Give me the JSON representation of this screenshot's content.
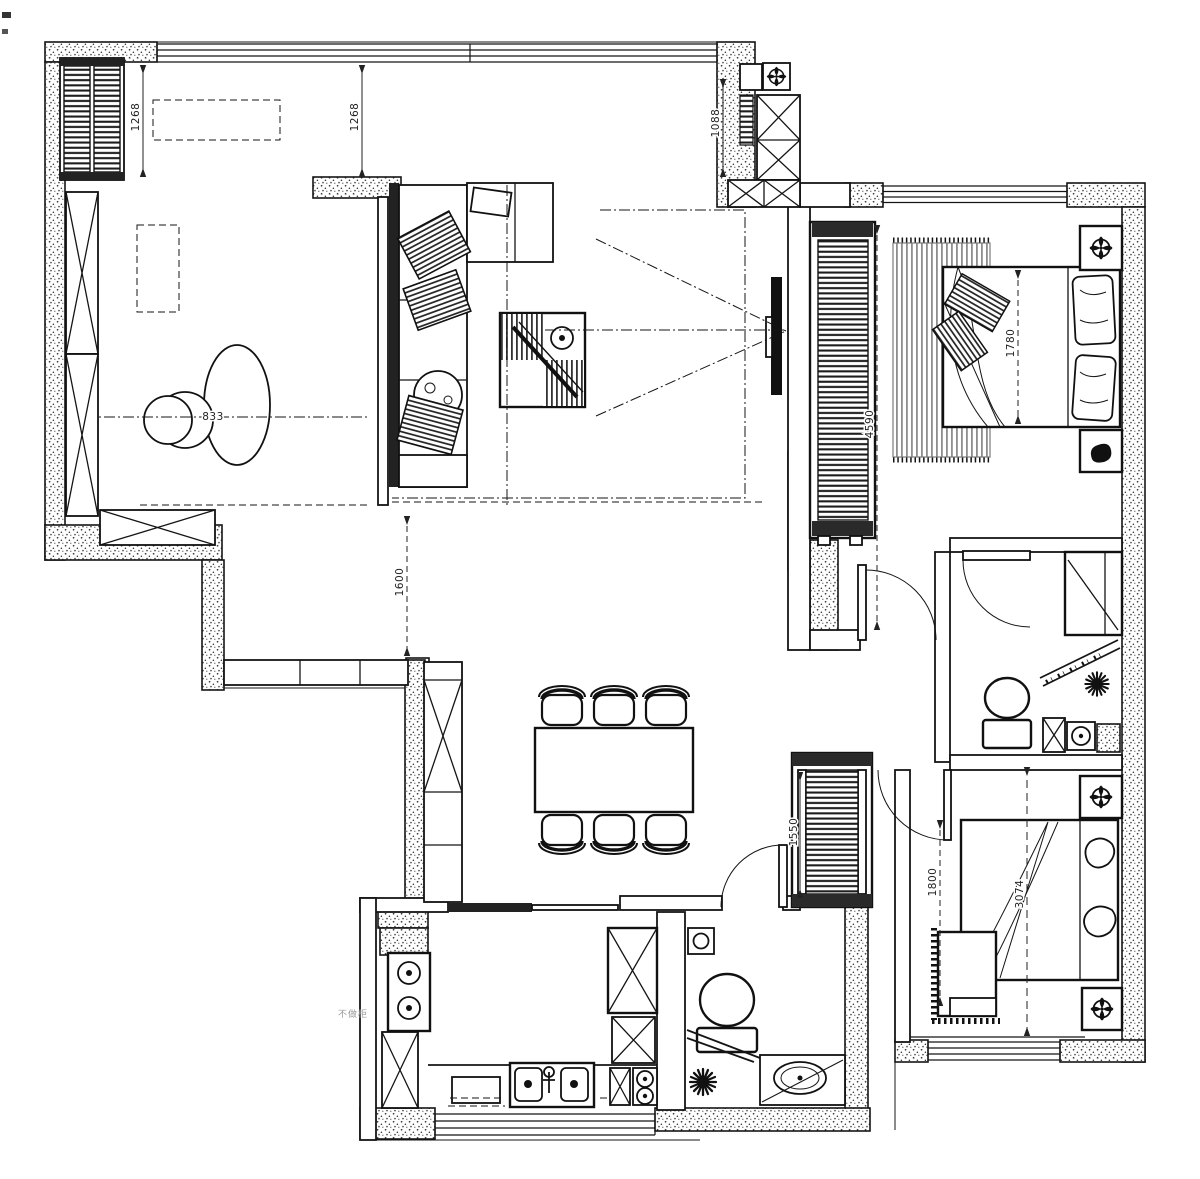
{
  "meta": {
    "drawing_type": "residential apartment floor plan",
    "style": "black and white CAD line drawing with stippled walls"
  },
  "colors": {
    "ink": "#151515",
    "paper": "#ffffff",
    "dim_text": "#222222",
    "note_text": "#9a9a9a"
  },
  "dims": {
    "study_bay_left": "1268",
    "study_bay_right": "1268",
    "entry_shaft": "1088",
    "corridor": "1600",
    "study_table": "833",
    "master_depth": "4590",
    "master_bed": "1780",
    "hall_closet": "1550",
    "bed2_left": "1800",
    "bed2_depth": "3074"
  },
  "notes": {
    "kitchen_wall": "不做柜"
  },
  "icons": [
    "ac-louver-icon",
    "l-sofa-icon",
    "lounge-chair-icon",
    "coffee-table-icon",
    "tv-icon",
    "viewing-triangle-icon",
    "dining-table-icon",
    "dining-chair-icon",
    "tall-cabinet-x-icon",
    "sliding-door-icon",
    "door-swing-icon",
    "window-band-icon",
    "gas-stove-icon",
    "kitchen-sink-icon",
    "cooktop-icon",
    "fridge-cabinet-icon",
    "range-hood-icon",
    "toilet-icon",
    "washbasin-icon",
    "floor-drain-star-icon",
    "shower-cabinet-icon",
    "wardrobe-louver-icon",
    "double-bed-icon",
    "pillow-icon",
    "rug-icon",
    "nightstand-icon",
    "ceiling-lamp-rosette-icon",
    "vent-rosette-icon",
    "desk-icon",
    "round-table-icon"
  ]
}
